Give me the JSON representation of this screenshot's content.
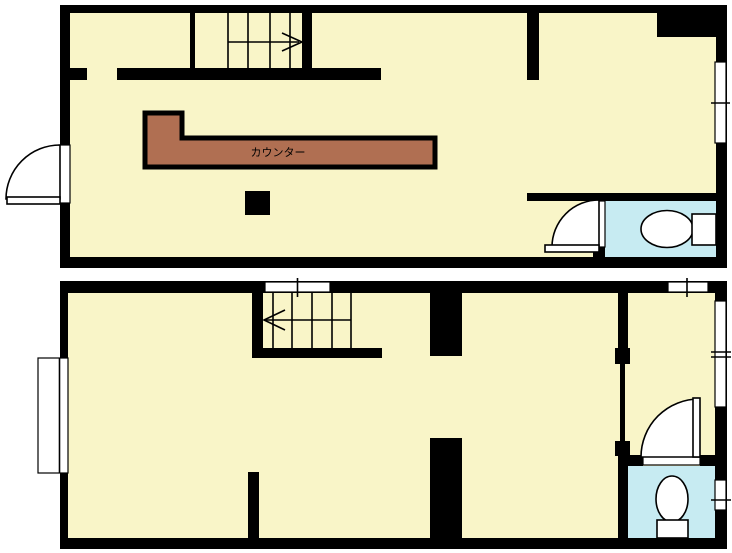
{
  "title": "two-story floor plan",
  "colors": {
    "background": "#FFFFFF",
    "wall": "#000000",
    "floor": "#F9F5C8",
    "toilet_floor": "#C7EBF2",
    "counter": "#B06F52",
    "fixture": "#FFFFFF"
  },
  "floor1": {
    "counter_label": "カウンター",
    "stairs_direction": "right",
    "features": [
      "stairs",
      "entrance-door",
      "counter",
      "pillar",
      "toilet",
      "toilet-door",
      "window-right"
    ]
  },
  "floor2": {
    "stairs_direction": "left",
    "features": [
      "stairs",
      "stair-top-opening",
      "window-left",
      "window-top",
      "window-right-tall",
      "window-right-small",
      "partition",
      "toilet",
      "toilet-door"
    ]
  }
}
